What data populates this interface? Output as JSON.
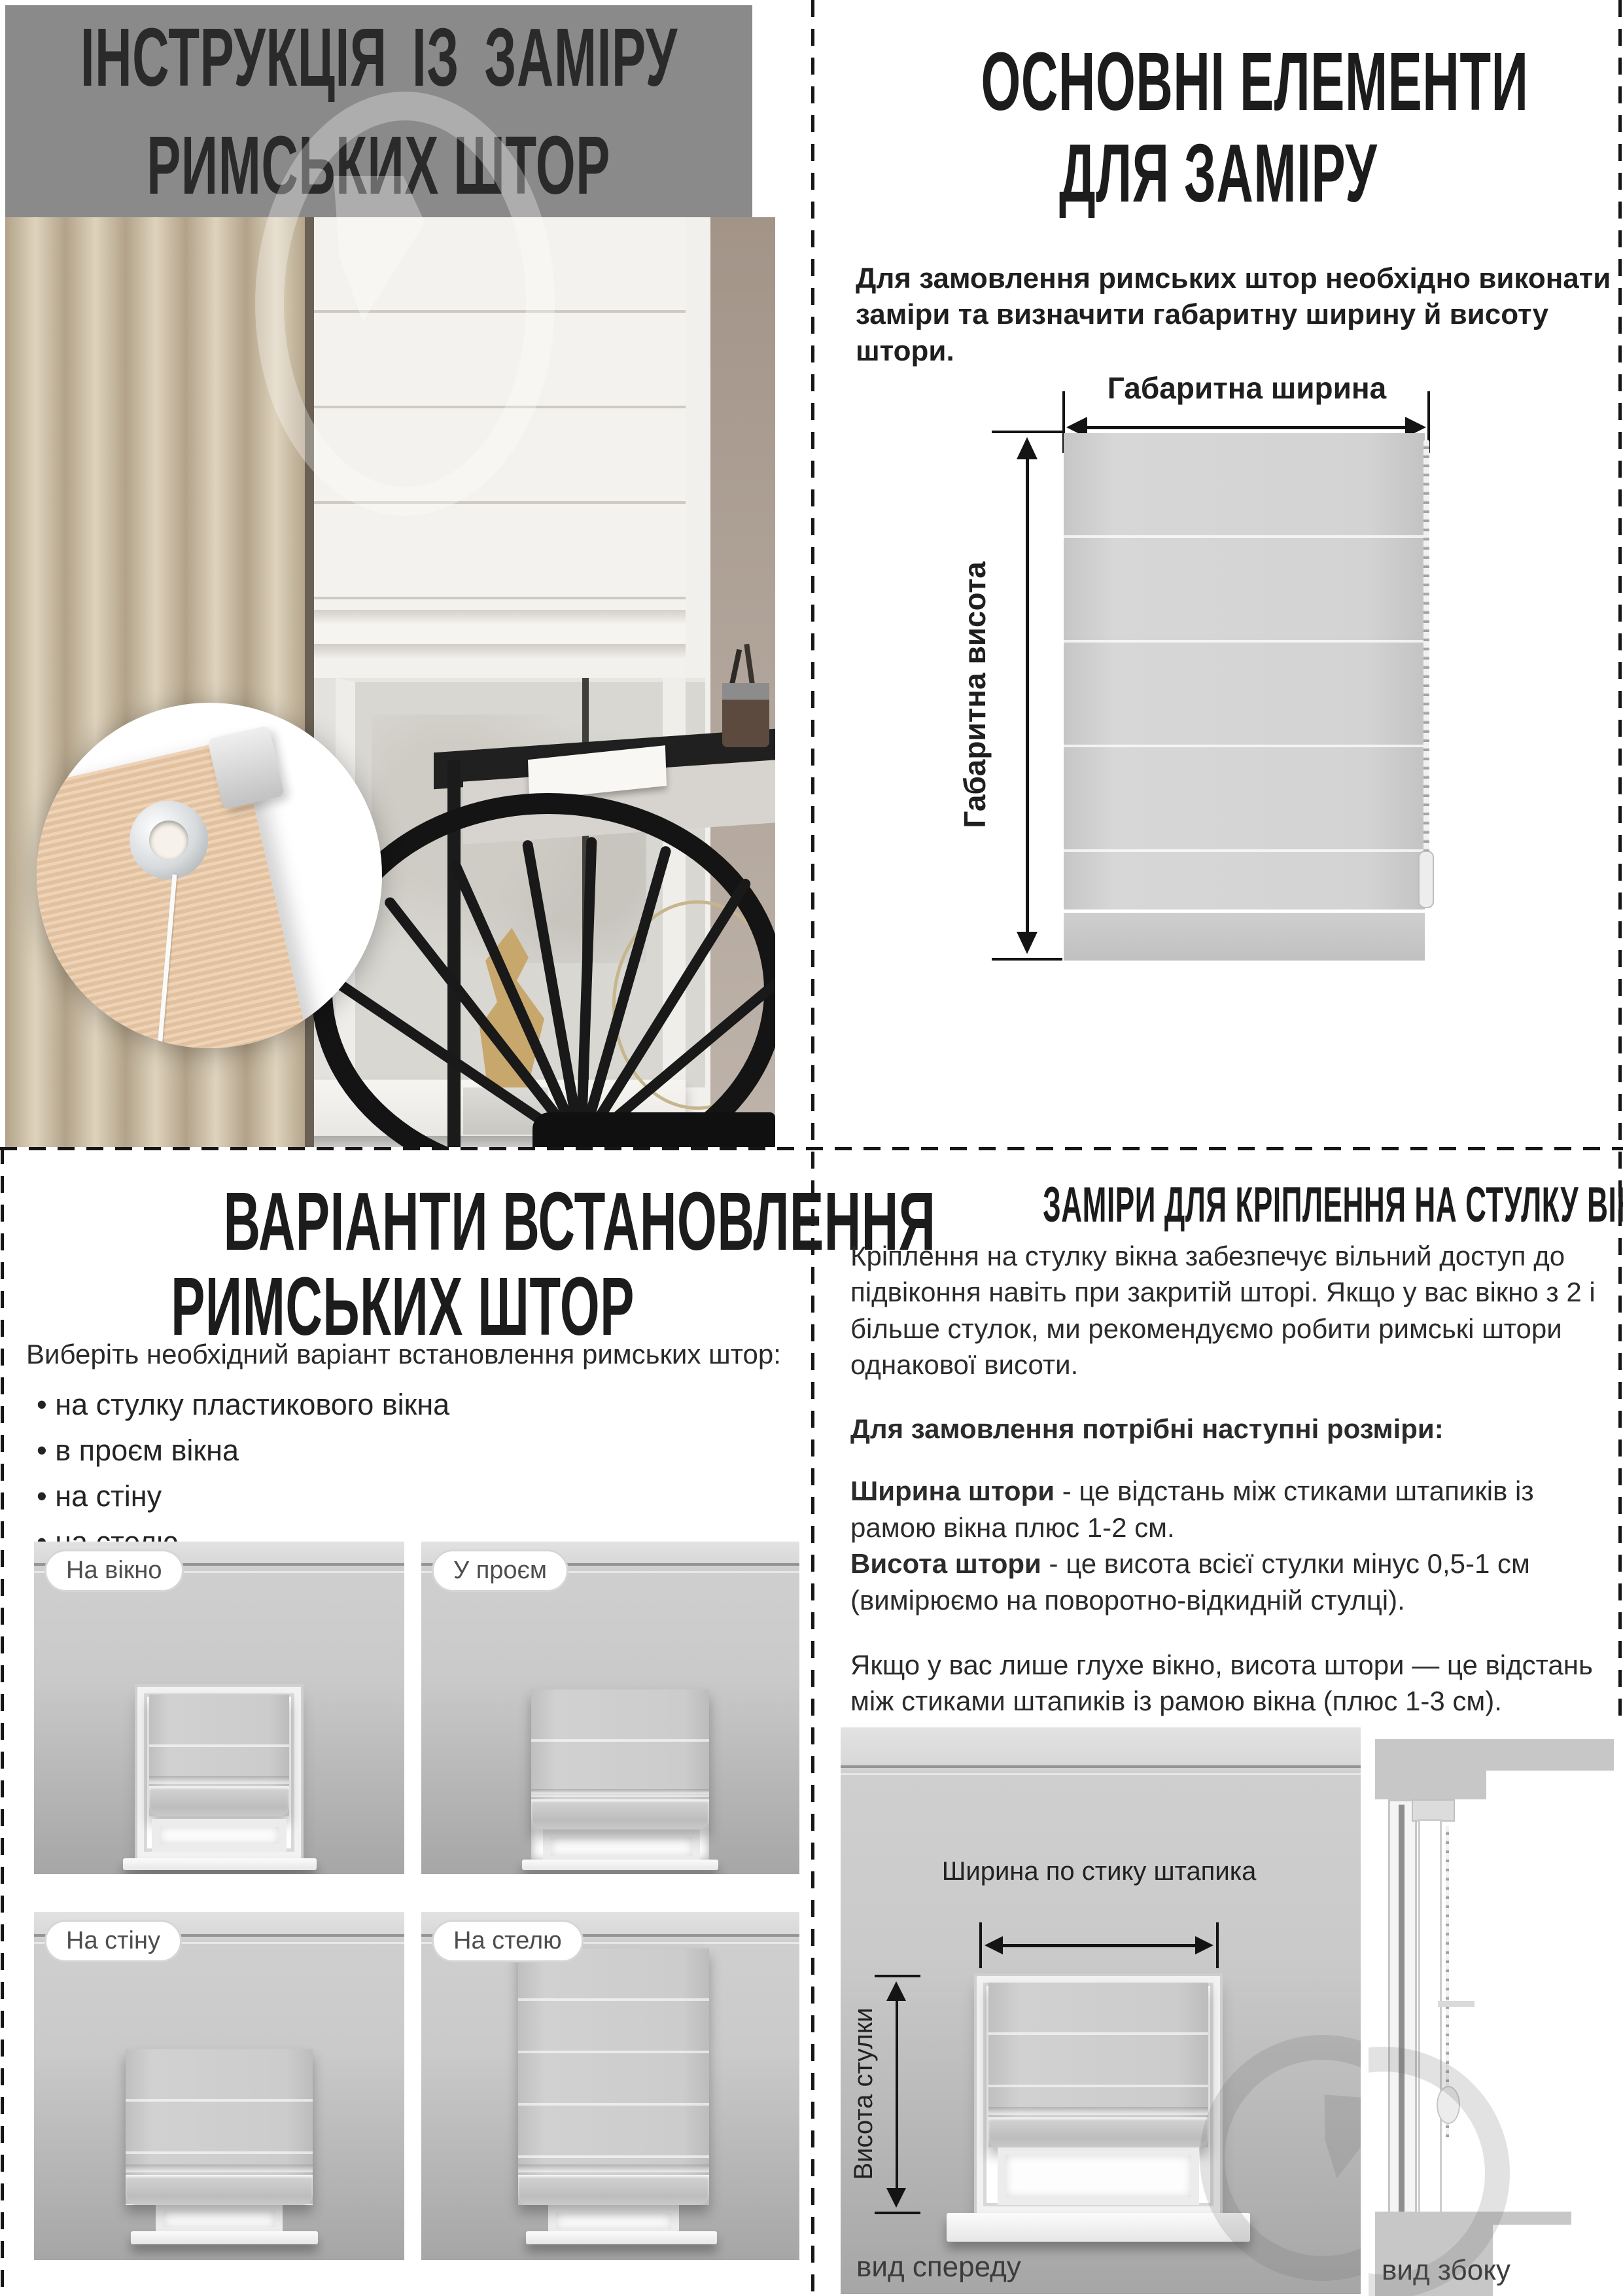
{
  "top_left": {
    "title_line1": "ІНСТРУКЦІЯ ІЗ ЗАМІРУ",
    "title_line2": "РИМСЬКИХ ШТОР"
  },
  "top_right": {
    "title_line1": "ОСНОВНІ ЕЛЕМЕНТИ",
    "title_line2": "ДЛЯ ЗАМІРУ",
    "intro": "Для замовлення римських штор необхідно виконати заміри та визначити габаритну ширину й висоту штори.",
    "diagram": {
      "width_label": "Габаритна ширина",
      "height_label": "Габаритна висота"
    }
  },
  "bottom_left": {
    "title_line1": "ВАРІАНТИ ВСТАНОВЛЕННЯ",
    "title_line2": "РИМСЬКИХ ШТОР",
    "intro": "Виберіть необхідний варіант встановлення римських штор:",
    "bullets": [
      "на стулку пластикового вікна",
      "в проєм вікна",
      "на стіну",
      "на стелю"
    ],
    "variants": [
      {
        "label": "На вікно"
      },
      {
        "label": "У проєм"
      },
      {
        "label": "На стіну"
      },
      {
        "label": "На стелю"
      }
    ]
  },
  "bottom_right": {
    "title": "ЗАМІРИ ДЛЯ КРІПЛЕННЯ НА СТУЛКУ ВІКНА",
    "paragraph1": "Кріплення на стулку вікна забезпечує вільний доступ до підвіконня навіть при закритій шторі. Якщо у вас вікно з 2 і більше стулок, ми рекомендуємо робити римські штори однакової висоти.",
    "sizes_lead": "Для замовлення потрібні наступні розміри:",
    "width_term": "Ширина штори",
    "width_def": " - це відстань між стиками штапиків із рамою вікна плюс 1-2 см.",
    "height_term": "Висота штори",
    "height_def": " - це висота всієї стулки мінус 0,5-1 см (вимірюємо на поворотно-відкидній стулці).",
    "paragraph2": "Якщо у вас лише глухе вікно, висота штори — це відстань між стиками штапиків із рамою вікна (плюс 1-3 см).",
    "diagram": {
      "width_label": "Ширина по стику штапика",
      "height_label": "Висота стулки",
      "front_view_label": "вид спереду",
      "side_view_label": "вид збоку"
    }
  },
  "colors": {
    "header_gray": "#8a8a8a",
    "text_dark": "#1c1c1c",
    "diagram_gray": "#d3d3d3",
    "curtain_beige": "#c9bca6"
  }
}
